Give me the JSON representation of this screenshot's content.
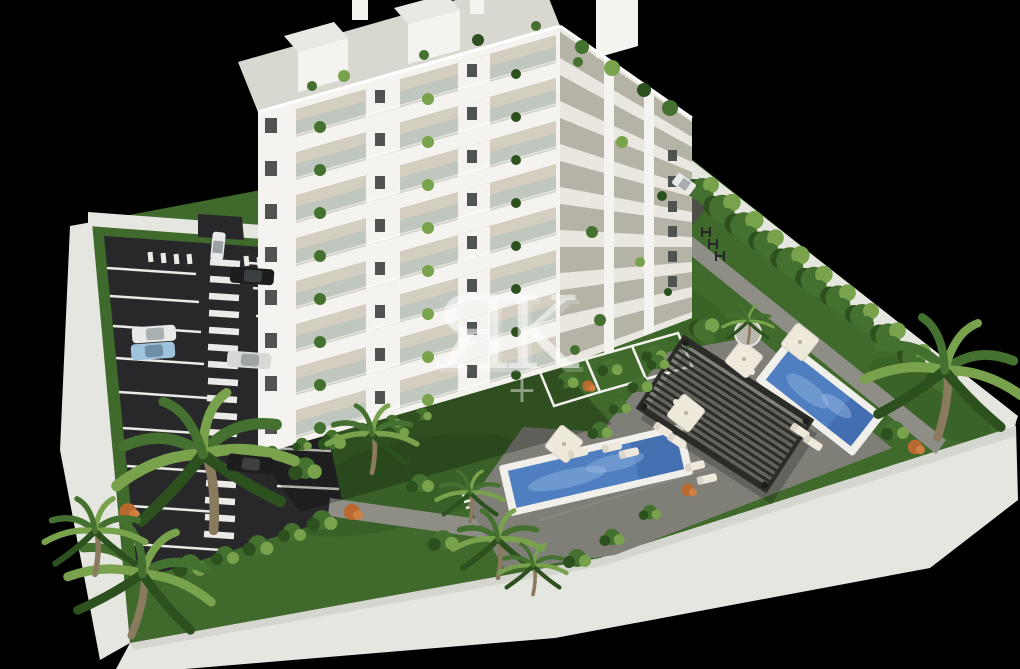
{
  "scene": {
    "type": "architectural-3d-aerial-render",
    "title": "Aerial 3D render of a white apartment block with gardens, two pools and a parking lot on black background",
    "watermark": {
      "text": "ЯK",
      "symbol": "+"
    },
    "site": {
      "building_floors_visible": 8,
      "pool_count": 2,
      "parked_car_count": 6,
      "car_colors": [
        "white",
        "black",
        "white",
        "light-blue",
        "silver",
        "black"
      ]
    },
    "colors": {
      "background": "#000000",
      "lawn": "#3f6a2b",
      "lawn_dark": "#2a4c1b",
      "wall": "#e6e6e0",
      "wall_shade": "#c6c6bf",
      "marking": "#eceae6",
      "asphalt": "#28282b",
      "path": "#8e8e87",
      "deck": "#7f7f78",
      "building": "#f4f3ef",
      "building_shade": "#e9e7e0",
      "roof": "#d9d8d0",
      "roof_light": "#e9e8e2",
      "balcony": "#d3cec0",
      "balcony_side": "#b5b3a6",
      "glass": "#b9c4bd",
      "window": "#4f5451",
      "plant": "#44712f",
      "plant_light": "#79a24c",
      "plant_dark": "#2c511f",
      "plant_orange": "#b9692f",
      "plant_orange2": "#cd8040",
      "trunk": "#8a7a5e",
      "pool_water": "#4f7fc0",
      "pool_deep": "#3a61a4",
      "pool_edge": "#f0efe9",
      "pergola": "#2b2b28",
      "furniture": "#efe9dc",
      "car_white": "#e9e9e7",
      "car_black": "#1d1d1f",
      "car_blue": "#9fc3dd",
      "car_silver": "#d8d8d6"
    }
  }
}
